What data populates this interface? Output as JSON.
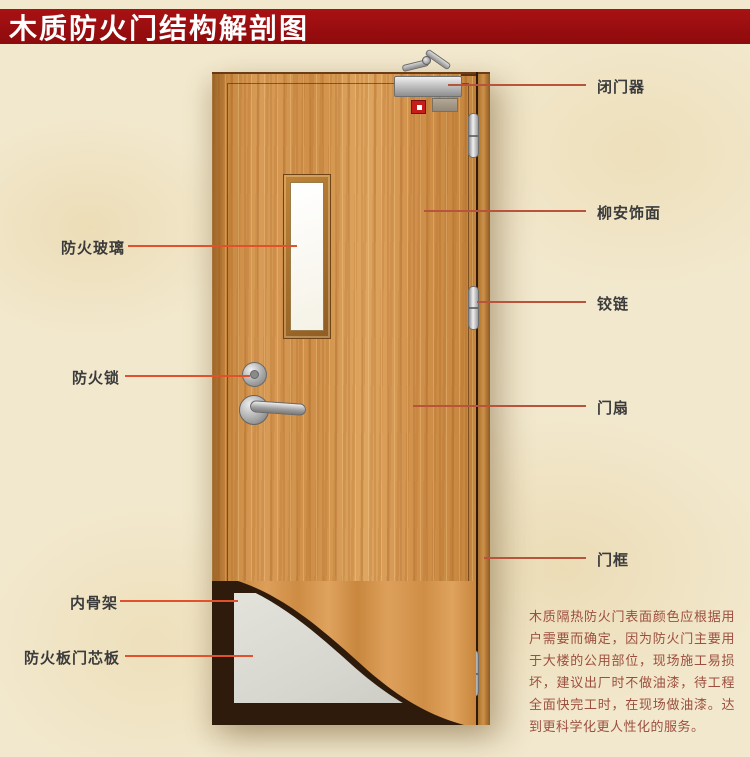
{
  "title": "木质防火门结构解剖图",
  "annotations": {
    "left": [
      {
        "label": "防火玻璃"
      },
      {
        "label": "防火锁"
      },
      {
        "label": "内骨架"
      },
      {
        "label": "防火板门芯板"
      }
    ],
    "right": [
      {
        "label": "闭门器"
      },
      {
        "label": "柳安饰面"
      },
      {
        "label": "铰链"
      },
      {
        "label": "门扇"
      },
      {
        "label": "门框"
      }
    ]
  },
  "note": "木质隔热防火门表面颜色应根据用户需要而确定，因为防火门主要用于大楼的公用部位，现场施工易损坏，建议出厂时不做油漆，待工程全面快完工时，在现场做油漆。达到更科学化更人性化的服务。",
  "colors": {
    "banner_bg": "#9e0c0e",
    "banner_text": "#ffffff",
    "background": "#f2e8cd",
    "leader_line_left": "#e0512c",
    "leader_line_right": "#b8533c",
    "label_text": "#3b3b3b",
    "note_text": "#9c4f3f",
    "door_wood": "#d2914c",
    "core_panel": "#d9d9d3",
    "inner_frame": "#2f1b0b"
  }
}
